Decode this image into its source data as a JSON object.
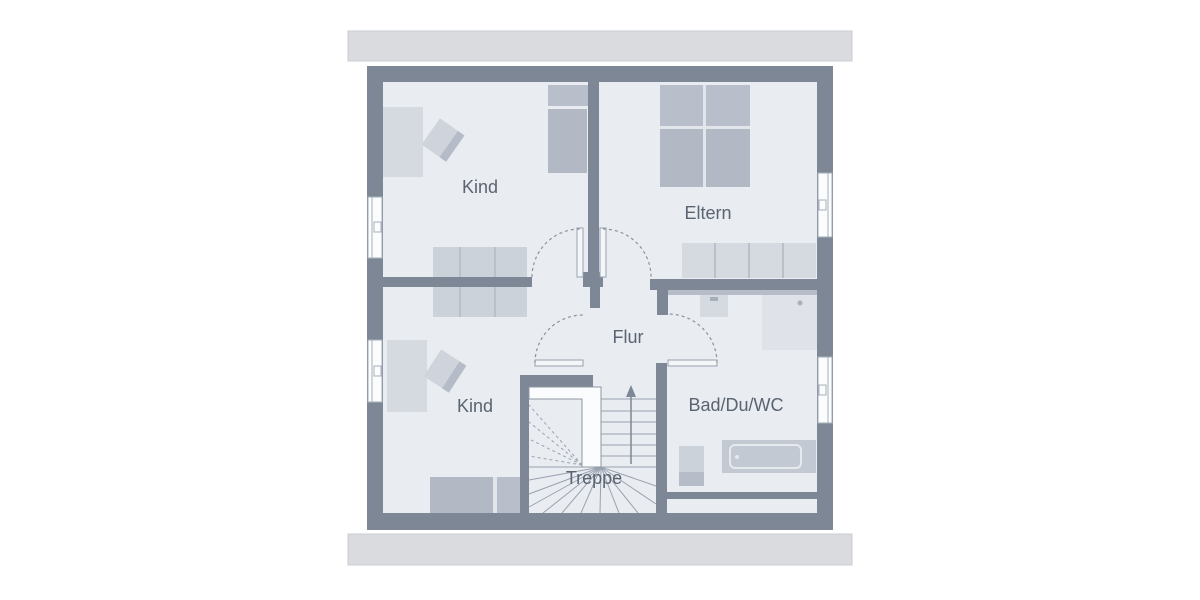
{
  "plan": {
    "type": "floor-plan",
    "labels": {
      "kind_upper": "Kind",
      "eltern": "Eltern",
      "flur": "Flur",
      "kind_lower": "Kind",
      "bad": "Bad/Du/WC",
      "treppe": "Treppe"
    },
    "colors": {
      "background": "#ffffff",
      "wall": "#7d8795",
      "floor": "#e9ecf1",
      "roof_overhang": "#d9dbdf",
      "furniture_light": "#d5dae1",
      "furniture_medium": "#b2b9c5",
      "window": "#fbfcfd",
      "label_text": "#5a6470"
    }
  }
}
